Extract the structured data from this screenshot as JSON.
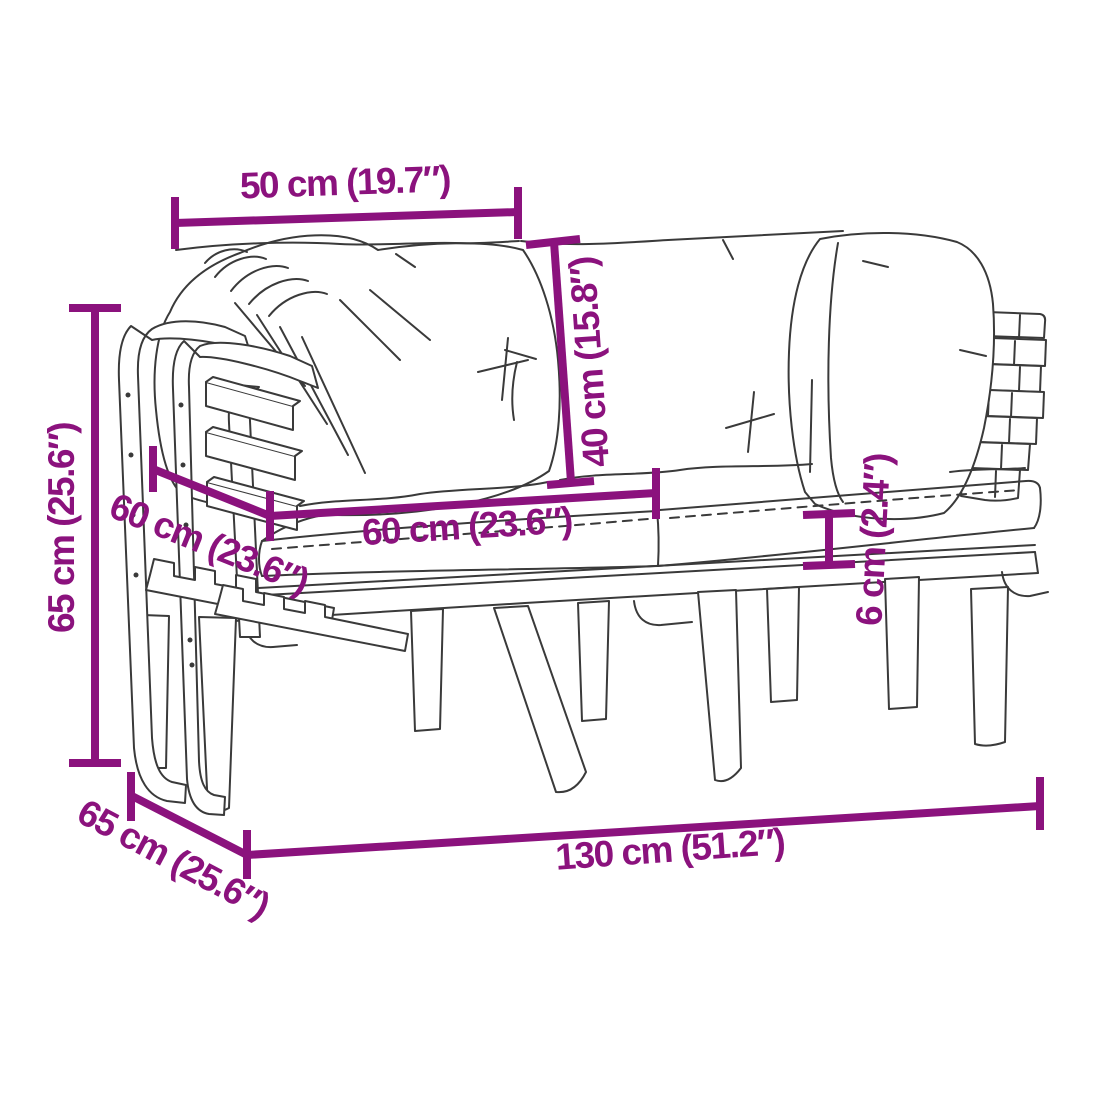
{
  "diagram": {
    "subject": "garden-sofa-with-cushions-line-drawing",
    "colors": {
      "dimension_annotation": "#8b127d",
      "drawing_outline": "#3a3a3a",
      "background": "#ffffff"
    },
    "dimensions": [
      {
        "id": "back-cushion-width",
        "label": "50 cm (19.7″)"
      },
      {
        "id": "back-cushion-height",
        "label": "40 cm (15.8″)"
      },
      {
        "id": "overall-height",
        "label": "65 cm (25.6″)"
      },
      {
        "id": "seat-cushion-depth",
        "label": "60 cm (23.6″)"
      },
      {
        "id": "seat-cushion-width",
        "label": "60 cm (23.6″)"
      },
      {
        "id": "seat-cushion-thickness",
        "label": "6 cm (2.4″)"
      },
      {
        "id": "overall-depth",
        "label": "65 cm (25.6″)"
      },
      {
        "id": "overall-width",
        "label": "130 cm (51.2″)"
      }
    ]
  }
}
